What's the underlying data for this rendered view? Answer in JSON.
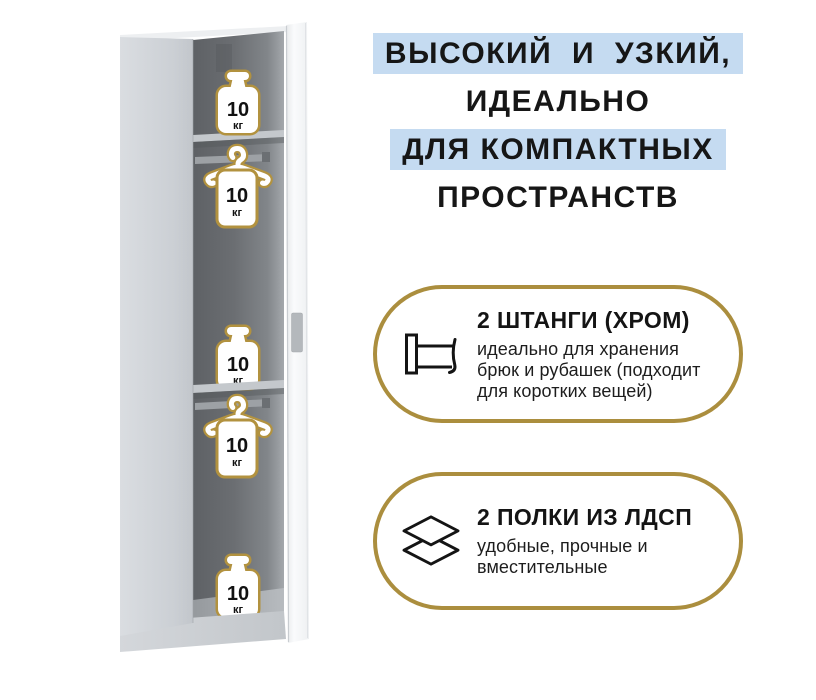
{
  "headline": {
    "lines": [
      {
        "text": "ВЫСОКИЙ И УЗКИЙ,",
        "highlighted": true
      },
      {
        "text": "ИДЕАЛЬНО",
        "highlighted": false
      },
      {
        "text": "ДЛЯ КОМПАКТНЫХ",
        "highlighted": true
      },
      {
        "text": "ПРОСТРАНСТВ",
        "highlighted": false
      }
    ],
    "highlight_color": "#c5dbf1",
    "text_color": "#161616"
  },
  "features": [
    {
      "icon": "clothes-rail-icon",
      "title": "2 ШТАНГИ (ХРОМ)",
      "description_lines": [
        "идеально для хранения",
        "брюк и рубашек (подходит",
        "для коротких вещей)"
      ]
    },
    {
      "icon": "stacked-shelves-icon",
      "title": "2 ПОЛКИ ИЗ ЛДСП",
      "description_lines": [
        "удобные, прочные и",
        "вместительные"
      ]
    }
  ],
  "cabinet": {
    "weight_badges": [
      {
        "value": "10",
        "unit": "кг",
        "location": "top-shelf"
      },
      {
        "value": "10",
        "unit": "кг",
        "location": "upper-hanger-rod"
      },
      {
        "value": "10",
        "unit": "кг",
        "location": "middle-shelf"
      },
      {
        "value": "10",
        "unit": "кг",
        "location": "lower-hanger-rod"
      },
      {
        "value": "10",
        "unit": "кг",
        "location": "bottom-compartment"
      }
    ],
    "rod_count": 2,
    "shelf_count": 2
  },
  "colors": {
    "accent_gold": "#ab8e3e",
    "icon_outline_gold": "#b2923f",
    "highlight_blue": "#c5dbf1",
    "interior_gray": "#6b6e72",
    "panel_gray": "#ced2d6"
  }
}
